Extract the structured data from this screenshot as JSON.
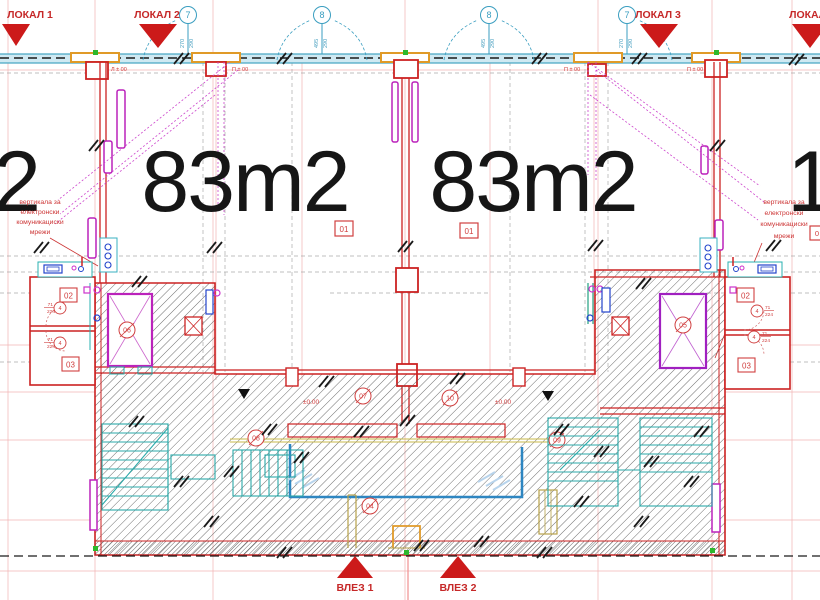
{
  "palette": {
    "wall_red": "#cc2222",
    "annotation_red": "#c62828",
    "magenta": "#bb22bb",
    "grid_cyan": "#3a9ec0",
    "stair_teal": "#2aa8a8",
    "pipe_blue": "#2e86c1",
    "fixture_blue": "#2244cc",
    "column_orange": "#e09a28",
    "olive": "#b8a24a",
    "green_marker": "#2db82d",
    "hatch_gray": "#555555",
    "construction_pink": "#f0a6a6",
    "text_black": "#161616"
  },
  "top_markers": {
    "lokal1": "ЛОКАЛ 1",
    "lokal2": "ЛОКАЛ 2",
    "lokal3": "ЛОКАЛ 3",
    "lokal4": "ЛОКАЛ 4"
  },
  "grid": {
    "bubble_7": "7",
    "bubble_8": "8",
    "dim_270": "270",
    "dim_290": "290",
    "dim_495": "495"
  },
  "levels": {
    "l_pm00": "Л ± 00",
    "p_pm00": "П ± 00",
    "pm000": "±0.00"
  },
  "areas": {
    "unit_left": "83m2",
    "unit_right": "83m2",
    "edge_left_partial": "2",
    "edge_right_partial": "1"
  },
  "room_tags": {
    "t01": "01",
    "t02": "02",
    "t03": "03",
    "t04": "04",
    "t05": "05",
    "t06": "06",
    "t07": "07",
    "t08": "08",
    "t09": "09",
    "t10": "10"
  },
  "detail_tags": {
    "bubble_4": "4",
    "dim_71": "71",
    "dim_224": "224",
    "edge_tag_partial": "0"
  },
  "notes": {
    "riser_line1": "вертикала за",
    "riser_line2": "електронски",
    "riser_line3": "комуникациски",
    "riser_line4": "мрежи"
  },
  "entrances": {
    "vlez1": "ВЛЕЗ 1",
    "vlez2": "ВЛЕЗ 2"
  }
}
